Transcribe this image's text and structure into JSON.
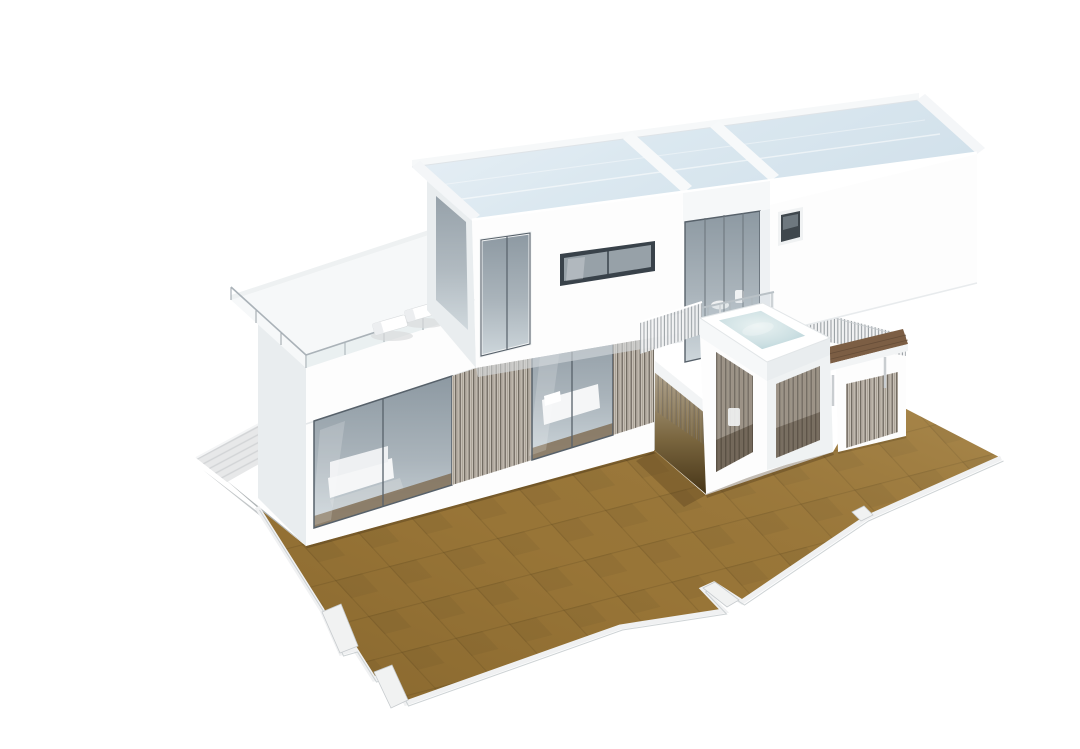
{
  "scene": {
    "description": "3D architectural render of a modern two-story modular house seen from an aerial three-quarter angle: white box volumes with glass skylight roofs, floor-to-ceiling glazing with timber slat screens, a roof terrace with sun loungers and glass railing, a rooftop jacuzzi pavilion with slatted screen walls, a timber deck walkway, a pale side boardwalk with cast shadow, and a large ochre tiled ground terrace with stepped edges on a plain white background",
    "background": "#ffffff",
    "view": "aerial axonometric render",
    "image_width": 1080,
    "image_height": 749
  },
  "palette": {
    "background": "#ffffff",
    "wall": "#fdfdfd",
    "wall_side": "#e9edef",
    "wall_soft": "#f6f8f9",
    "glass": "#9fabb3",
    "glass_deep": "#8d99a2",
    "glass_light": "#cdd6db",
    "skylight": "#d9e6ee",
    "skylight_hi": "#eaf1f7",
    "interior": "#aeb7bd",
    "furniture": "#f5f6f7",
    "slat_bg": "#c6bfb5",
    "slat_line": "#6e675e",
    "terrace": "#9c7839",
    "terrace_line": "#6d5326",
    "terrace_edge": "#f1f2f2",
    "water": "#bed8dc",
    "water_hi": "#e9f2f2",
    "deck": "#7c5e44",
    "deck_dark": "#5e4733",
    "walkway": "#e7e8e9",
    "walkway_line": "#d2d4d6",
    "shadow_dark": "#b0b5b7",
    "shadow_soft": "#dcdedf",
    "frame": "#57616a",
    "edge": "#c6cbce"
  },
  "objects": {
    "terrace": {
      "label": "ochre tiled ground terrace with stepped slab edges"
    },
    "walkway": {
      "label": "pale plank boardwalk at the left side"
    },
    "wall_shadow": {
      "label": "shadow cast by the house onto the boardwalk"
    },
    "ground_floor": {
      "label": "glazed living module with sliding glass walls and timber slat screens"
    },
    "roof_terrace": {
      "label": "roof terrace with glass railing and two sun loungers"
    },
    "upper_volume": {
      "label": "upper bedroom volume with corner window and ribbon window"
    },
    "upper_doors": {
      "label": "recessed sliding glass doors to the pool terrace"
    },
    "right_volume": {
      "label": "right bedroom volume with small square window"
    },
    "skylights": {
      "label": "glass skylight roof panels"
    },
    "jacuzzi": {
      "label": "rooftop jacuzzi with pale blue water"
    },
    "pavilion": {
      "label": "white pavilion with vertical slat screens below the jacuzzi"
    },
    "deck": {
      "label": "elevated timber deck walkway with slat railing"
    },
    "porch": {
      "label": "shaded ground-floor porch beneath the bridge"
    }
  }
}
